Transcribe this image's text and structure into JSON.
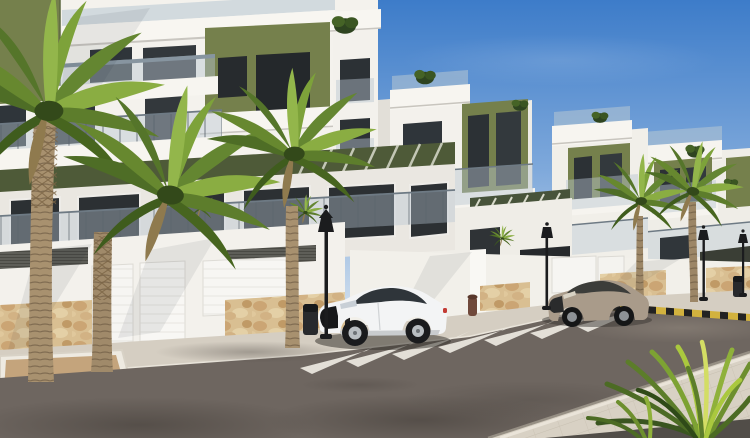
{
  "scene": {
    "description": "3D architectural render of a modern white apartment complex street view",
    "elements": [
      "apartment buildings with olive accent panels",
      "glass balcony railings",
      "palm trees",
      "white coupe car",
      "beige coupe car",
      "zebra crosswalk",
      "street lamps",
      "garage doors",
      "stone clad wall base",
      "paved sidewalk",
      "asphalt road"
    ]
  },
  "palette": {
    "sky_top": "#3d7cc9",
    "sky_mid": "#7fa9db",
    "sky_horizon": "#cfdeed",
    "wall_white": "#f4f2ed",
    "wall_shaded": "#e8e5df",
    "accent_olive": "#75804c",
    "accent_olive_dark": "#4e5a38",
    "glass_dark": "#2c3135",
    "railing_glass": "#b7c6d1",
    "stone_beige": "#d9bf92",
    "road_asphalt": "#6e6660",
    "sidewalk_far": "#d5cec2",
    "sidewalk_near": "#d8d1c4",
    "crosswalk_white": "#edeae2",
    "curb_yellow": "#d2b23e",
    "palm_dark": "#486724",
    "palm_light": "#8aad42",
    "palm_trunk": "#a8916f",
    "planter_sand": "#c4a47c",
    "car_white": "#f3f4f5",
    "car_beige": "#a99b8a",
    "lamp_black": "#1b1c1e"
  },
  "objects": {
    "buildings": 4,
    "palm_trees": 5,
    "vehicles": [
      {
        "type": "white coupe",
        "facing": "left"
      },
      {
        "type": "beige coupe",
        "facing": "left"
      }
    ],
    "street_lamps": 4,
    "trash_bins": 2,
    "crosswalk_stripes": 7,
    "garage_doors": 3
  }
}
